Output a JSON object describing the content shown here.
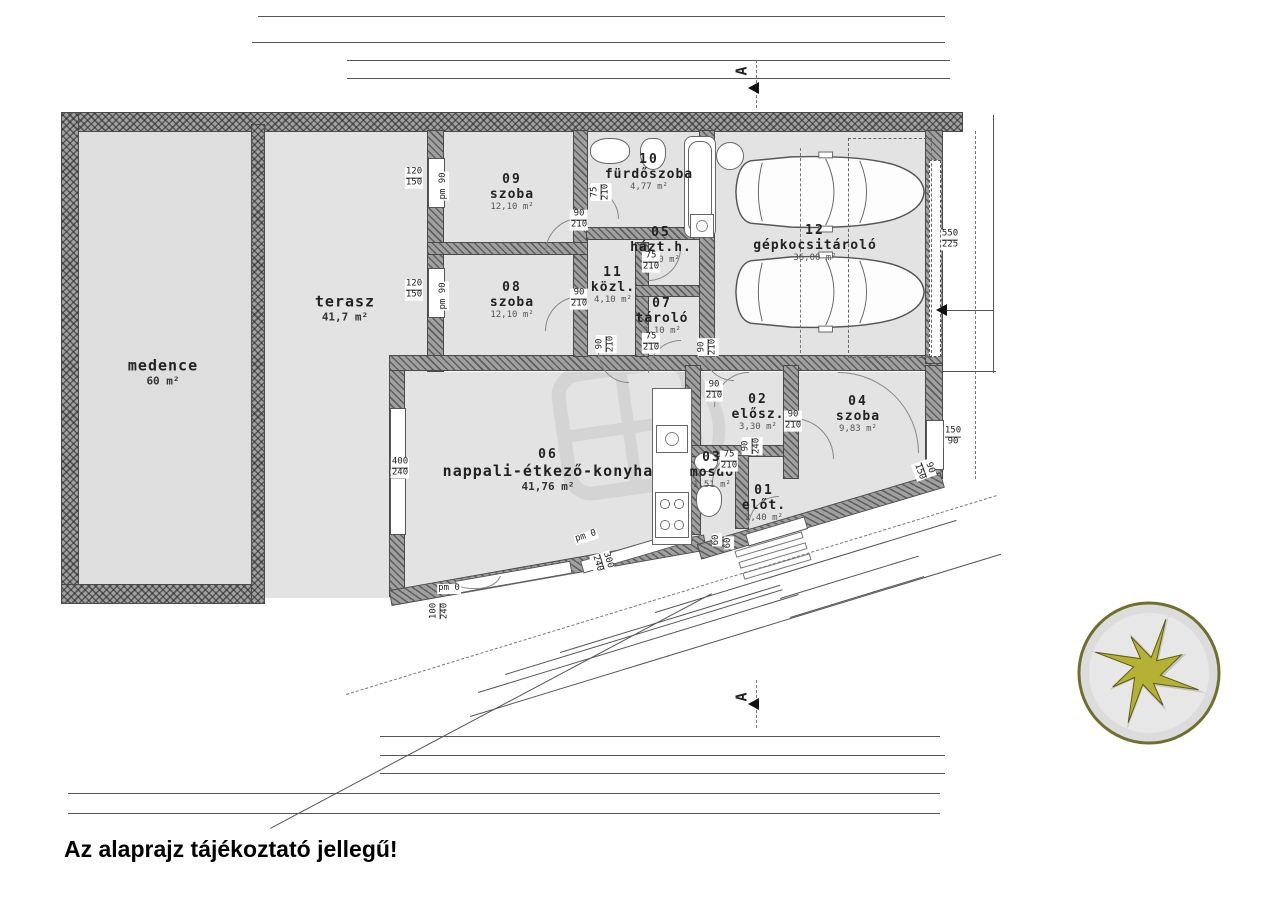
{
  "disclaimer": "Az alaprajz tájékoztató jellegű!",
  "section_marker": "A",
  "rooms": [
    {
      "name": "medence",
      "area": "60 m²",
      "x": 163,
      "y": 372,
      "cls": "big"
    },
    {
      "name": "terasz",
      "area": "41,7 m²",
      "x": 345,
      "y": 308,
      "cls": "big"
    },
    {
      "num": "09",
      "name": "szoba",
      "area": "12,10 m²",
      "x": 512,
      "y": 192
    },
    {
      "num": "10",
      "name": "fürdőszoba",
      "area": "4,77 m²",
      "x": 649,
      "y": 172
    },
    {
      "num": "05",
      "name": "házt.h.",
      "area": "3,10 m²",
      "x": 661,
      "y": 245
    },
    {
      "num": "11",
      "name": "közl.",
      "area": "4,10 m²",
      "x": 613,
      "y": 285
    },
    {
      "num": "08",
      "name": "szoba",
      "area": "12,10 m²",
      "x": 512,
      "y": 300
    },
    {
      "num": "07",
      "name": "tároló",
      "area": "3,10 m²",
      "x": 662,
      "y": 316
    },
    {
      "num": "12",
      "name": "gépkocsitároló",
      "area": "36,00 m²",
      "x": 815,
      "y": 243
    },
    {
      "num": "06",
      "name": "nappali-étkező-konyha",
      "area": "41,76 m²",
      "x": 548,
      "y": 470,
      "cls": "big"
    },
    {
      "num": "02",
      "name": "elősz.",
      "area": "3,30 m²",
      "x": 758,
      "y": 412
    },
    {
      "num": "04",
      "name": "szoba",
      "area": "9,83 m²",
      "x": 858,
      "y": 414
    },
    {
      "num": "03",
      "name": "mosdó",
      "area": "1,51 m²",
      "x": 712,
      "y": 470
    },
    {
      "num": "01",
      "name": "előt.",
      "area": "2,40 m²",
      "x": 764,
      "y": 503
    }
  ],
  "openings": [
    {
      "t1": "120",
      "t2": "150",
      "x": 414,
      "y": 178
    },
    {
      "t1": "pm 90",
      "x": 444,
      "y": 186,
      "rot": -90,
      "cls": "sm"
    },
    {
      "t1": "120",
      "t2": "150",
      "x": 414,
      "y": 290
    },
    {
      "t1": "pm 90",
      "x": 444,
      "y": 296,
      "rot": -90,
      "cls": "sm"
    },
    {
      "t1": "90",
      "t2": "210",
      "x": 579,
      "y": 220
    },
    {
      "t1": "75",
      "t2": "210",
      "x": 601,
      "y": 192,
      "rot": -90
    },
    {
      "t1": "75",
      "t2": "210",
      "x": 651,
      "y": 262
    },
    {
      "t1": "90",
      "t2": "210",
      "x": 579,
      "y": 299
    },
    {
      "t1": "75",
      "t2": "210",
      "x": 651,
      "y": 343
    },
    {
      "t1": "90",
      "t2": "210",
      "x": 606,
      "y": 344,
      "rot": -90
    },
    {
      "t1": "90",
      "t2": "210",
      "x": 708,
      "y": 347,
      "rot": -90
    },
    {
      "t1": "90",
      "t2": "210",
      "x": 714,
      "y": 391
    },
    {
      "t1": "90",
      "t2": "210",
      "x": 793,
      "y": 421
    },
    {
      "t1": "75",
      "t2": "210",
      "x": 729,
      "y": 461
    },
    {
      "t1": "90",
      "t2": "240",
      "x": 752,
      "y": 446,
      "rot": -90
    },
    {
      "t1": "550",
      "t2": "225",
      "x": 950,
      "y": 240
    },
    {
      "t1": "150",
      "t2": "90",
      "x": 953,
      "y": 437
    },
    {
      "t1": "90",
      "t2": "150",
      "x": 924,
      "y": 470,
      "rot": 70
    },
    {
      "t1": "400",
      "t2": "240",
      "x": 400,
      "y": 468
    },
    {
      "t1": "pm 0",
      "x": 449,
      "y": 589,
      "cls": "sm"
    },
    {
      "t1": "100",
      "t2": "240",
      "x": 440,
      "y": 611,
      "rot": -90
    },
    {
      "t1": "pm 0",
      "x": 586,
      "y": 537,
      "rot": -17,
      "cls": "sm"
    },
    {
      "t1": "300",
      "t2": "240",
      "x": 602,
      "y": 562,
      "rot": 73
    },
    {
      "t1": "60",
      "x": 717,
      "y": 540,
      "rot": -90,
      "cls": "sm"
    },
    {
      "t1": "60",
      "x": 729,
      "y": 543,
      "rot": -90,
      "cls": "sm"
    }
  ],
  "dim_labels": [
    {
      "t": "3,30",
      "x": 302,
      "y": 13
    },
    {
      "t": "14,90",
      "x": 655,
      "y": 13
    },
    {
      "t": "30",
      "x": 260,
      "y": 36,
      "cls": "sm"
    },
    {
      "t": "3,00",
      "x": 302,
      "y": 39
    },
    {
      "t": "95",
      "x": 356,
      "y": 39,
      "cls": "sm"
    },
    {
      "t": "13,95",
      "x": 652,
      "y": 39
    },
    {
      "t": "95",
      "x": 354,
      "y": 57,
      "cls": "sm"
    },
    {
      "t": "10 30",
      "x": 381,
      "y": 52,
      "cls": "sm"
    },
    {
      "t": "4,10",
      "x": 462,
      "y": 57
    },
    {
      "t": "10",
      "x": 547,
      "y": 52,
      "cls": "sm"
    },
    {
      "t": "2,65",
      "x": 603,
      "y": 57
    },
    {
      "t": "30",
      "x": 668,
      "y": 52,
      "cls": "sm"
    },
    {
      "t": "6,00",
      "x": 800,
      "y": 57
    },
    {
      "t": "30 10",
      "x": 935,
      "y": 52,
      "cls": "sm"
    },
    {
      "t": "95",
      "x": 354,
      "y": 75,
      "cls": "sm"
    },
    {
      "t": "10 30",
      "x": 381,
      "y": 70,
      "cls": "sm"
    },
    {
      "t": "4,10",
      "x": 462,
      "y": 75
    },
    {
      "t": "10",
      "x": 547,
      "y": 70,
      "cls": "sm"
    },
    {
      "t": "1,00",
      "x": 570,
      "y": 75
    },
    {
      "t": "10",
      "x": 592,
      "y": 70,
      "cls": "sm"
    },
    {
      "t": "1,55",
      "x": 622,
      "y": 75
    },
    {
      "t": "30",
      "x": 668,
      "y": 70,
      "cls": "sm"
    },
    {
      "t": "6,00",
      "x": 800,
      "y": 75
    },
    {
      "t": "30 10",
      "x": 935,
      "y": 70,
      "cls": "sm"
    },
    {
      "t": "1,04⁵",
      "x": 400,
      "y": 733
    },
    {
      "t": "1,00",
      "x": 441,
      "y": 733
    },
    {
      "t": "71",
      "x": 477,
      "y": 733,
      "cls": "sm"
    },
    {
      "t": "6,84⁵",
      "x": 610,
      "y": 733
    },
    {
      "t": "1,00",
      "x": 764,
      "y": 733
    },
    {
      "t": "1,15",
      "x": 806,
      "y": 733
    },
    {
      "t": "3,10",
      "x": 883,
      "y": 733
    },
    {
      "t": "10 30",
      "x": 393,
      "y": 748,
      "cls": "sm"
    },
    {
      "t": "7,80",
      "x": 547,
      "y": 752
    },
    {
      "t": "10",
      "x": 697,
      "y": 748,
      "cls": "sm"
    },
    {
      "t": "90",
      "x": 714,
      "y": 752,
      "cls": "sm"
    },
    {
      "t": "10",
      "x": 745,
      "y": 748,
      "cls": "sm"
    },
    {
      "t": "1,40",
      "x": 769,
      "y": 752
    },
    {
      "t": "10",
      "x": 792,
      "y": 748,
      "cls": "sm"
    },
    {
      "t": "3,70",
      "x": 862,
      "y": 752
    },
    {
      "t": "30 10",
      "x": 932,
      "y": 748,
      "cls": "sm"
    },
    {
      "t": "10 30",
      "x": 393,
      "y": 766,
      "cls": "sm"
    },
    {
      "t": "7,80",
      "x": 547,
      "y": 770
    },
    {
      "t": "10",
      "x": 697,
      "y": 766,
      "cls": "sm"
    },
    {
      "t": "90",
      "x": 714,
      "y": 770,
      "cls": "sm"
    },
    {
      "t": "30 10",
      "x": 750,
      "y": 766,
      "cls": "sm"
    },
    {
      "t": "2,20",
      "x": 806,
      "y": 770
    },
    {
      "t": "3,10",
      "x": 883,
      "y": 770
    },
    {
      "t": "30",
      "x": 74,
      "y": 787,
      "cls": "sm"
    },
    {
      "t": "30",
      "x": 266,
      "y": 786,
      "cls": "sm"
    },
    {
      "t": "3,00",
      "x": 325,
      "y": 790
    },
    {
      "t": "2,75⁵",
      "x": 437,
      "y": 790
    },
    {
      "t": "6,84⁵",
      "x": 610,
      "y": 790
    },
    {
      "t": "2,20",
      "x": 806,
      "y": 790
    },
    {
      "t": "3,10",
      "x": 883,
      "y": 790
    },
    {
      "t": "3,30",
      "x": 330,
      "y": 810
    },
    {
      "t": "14,90",
      "x": 655,
      "y": 810
    },
    {
      "t": "1,68",
      "x": 690,
      "y": 598,
      "rot": -17
    },
    {
      "t": "60",
      "x": 734,
      "y": 585,
      "rot": -17,
      "cls": "sm"
    },
    {
      "t": "46⁵",
      "x": 750,
      "y": 577,
      "rot": -17,
      "cls": "sm"
    },
    {
      "t": "2,32",
      "x": 796,
      "y": 565,
      "rot": -17
    },
    {
      "t": "2,16⁵",
      "x": 879,
      "y": 540,
      "rot": -17
    },
    {
      "t": "90",
      "x": 934,
      "y": 519,
      "rot": -17,
      "cls": "sm"
    },
    {
      "t": "20",
      "x": 952,
      "y": 508,
      "rot": -17,
      "cls": "sm"
    },
    {
      "t": "2,32",
      "x": 804,
      "y": 588,
      "rot": -17
    },
    {
      "t": "30",
      "x": 856,
      "y": 578,
      "rot": -17,
      "cls": "sm"
    },
    {
      "t": "3,26⁵",
      "x": 904,
      "y": 556,
      "rot": -17
    },
    {
      "t": "2,32",
      "x": 813,
      "y": 606,
      "rot": -17
    },
    {
      "t": "2,96⁵",
      "x": 915,
      "y": 575,
      "rot": -17
    },
    {
      "t": "3,00",
      "x": 613,
      "y": 632,
      "rot": -17
    },
    {
      "t": "30",
      "x": 765,
      "y": 612,
      "rot": -17,
      "cls": "sm"
    },
    {
      "t": "7,21",
      "x": 634,
      "y": 650,
      "rot": -17
    },
    {
      "t": "1,46⁵",
      "x": 527,
      "y": 668,
      "rot": -17
    },
    {
      "t": "6,91",
      "x": 638,
      "y": 668,
      "rot": -17
    },
    {
      "t": "12,79⁵",
      "x": 743,
      "y": 650,
      "rot": -17
    },
    {
      "t": "162°",
      "x": 480,
      "y": 563
    },
    {
      "t": "108°",
      "x": 878,
      "y": 393
    },
    {
      "t": "±0,00",
      "x": 368,
      "y": 421,
      "cls": "lvl"
    },
    {
      "t": "±0,00",
      "x": 430,
      "y": 421,
      "cls": "lvl"
    },
    {
      "t": "±0,00",
      "x": 901,
      "y": 328,
      "cls": "lvl"
    },
    {
      "t": "±0,00",
      "x": 946,
      "y": 328,
      "cls": "lvl"
    },
    {
      "t": "-0,30",
      "x": 963,
      "y": 372,
      "cls": "lvl"
    },
    {
      "t": "±0,00",
      "x": 757,
      "y": 444,
      "cls": "lvl"
    },
    {
      "t": "±0,00",
      "x": 796,
      "y": 494,
      "cls": "lvl"
    },
    {
      "t": "-0,30",
      "x": 806,
      "y": 521,
      "cls": "lvl"
    }
  ],
  "compass": {
    "labels": [
      {
        "t": "K",
        "x": 92,
        "y": 10,
        "rot": -60
      },
      {
        "t": "DK",
        "x": 136,
        "y": 38,
        "rot": -30
      },
      {
        "t": "D",
        "x": 147,
        "y": 88,
        "rot": -90
      },
      {
        "t": "DNY",
        "x": 117,
        "y": 138,
        "rot": -60
      },
      {
        "t": "NY",
        "x": 64,
        "y": 146,
        "rot": -70
      },
      {
        "t": "ÉNY",
        "x": 16,
        "y": 122,
        "rot": -45
      },
      {
        "t": "É",
        "x": 6,
        "y": 70,
        "rot": -80
      },
      {
        "t": "ÉK",
        "x": 30,
        "y": 24,
        "rot": -55
      }
    ]
  }
}
